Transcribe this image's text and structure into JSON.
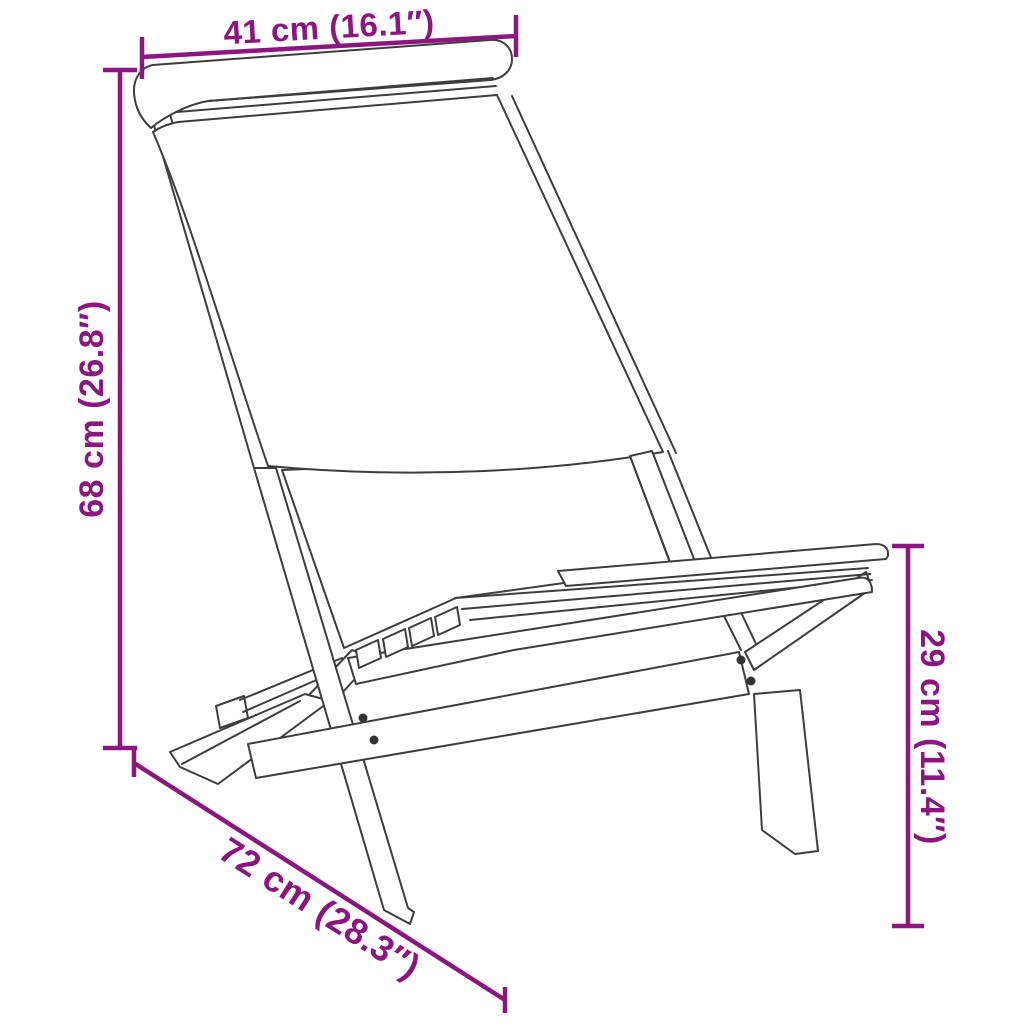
{
  "diagram": {
    "subject": "folding-chair-line-drawing",
    "dimensions": {
      "width": {
        "label": "41 cm (16.1″)",
        "cm": 41,
        "inches": 16.1,
        "position": "top"
      },
      "height": {
        "label": "68 cm (26.8″)",
        "cm": 68,
        "inches": 26.8,
        "position": "left"
      },
      "depth": {
        "label": "72 cm (28.3″)",
        "cm": 72,
        "inches": 28.3,
        "position": "bottom-diagonal"
      },
      "seat_height": {
        "label": "29 cm (11.4″)",
        "cm": 29,
        "inches": 11.4,
        "position": "right"
      }
    },
    "colors": {
      "accent": "#8C1680",
      "line_art": "#3D3D3D",
      "screw": "#333333",
      "background": "#FFFFFF"
    }
  }
}
